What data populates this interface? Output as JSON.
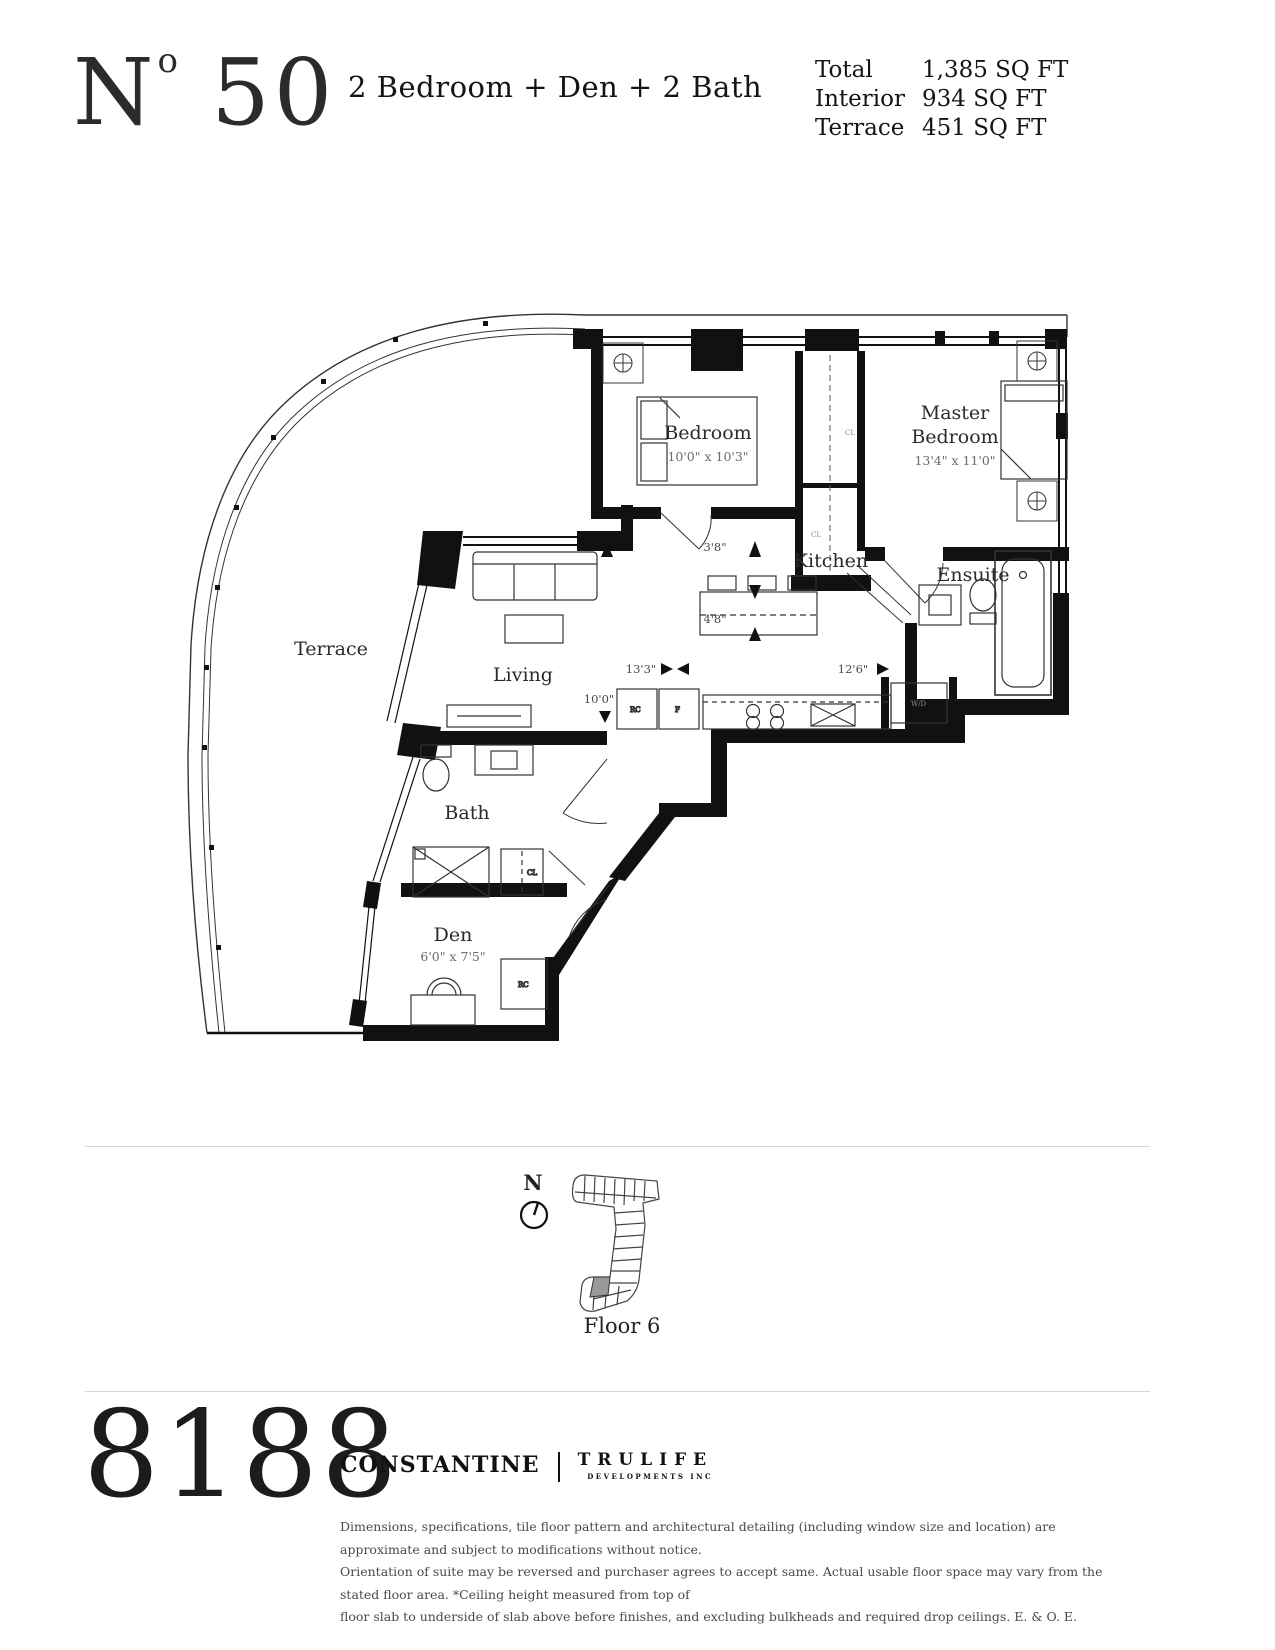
{
  "header": {
    "logo_n": "N",
    "logo_sup": "o",
    "logo_num": " 50",
    "title": "2 Bedroom + Den + 2 Bath",
    "stats": [
      {
        "label": "Total",
        "value": "1,385 SQ FT"
      },
      {
        "label": "Interior",
        "value": "934 SQ FT"
      },
      {
        "label": "Terrace",
        "value": "451 SQ FT"
      }
    ]
  },
  "plan": {
    "rooms": {
      "terrace": {
        "label": "Terrace"
      },
      "living": {
        "label": "Living"
      },
      "kitchen": {
        "label": "Kitchen"
      },
      "bedroom": {
        "label": "Bedroom",
        "dims": "10'0\" x 10'3\""
      },
      "master": {
        "label_line1": "Master",
        "label_line2": "Bedroom",
        "dims": "13'4\" x 11'0\""
      },
      "ensuite": {
        "label": "Ensuite"
      },
      "bath": {
        "label": "Bath"
      },
      "den": {
        "label": "Den",
        "dims": "6'0\" x 7'5\""
      }
    },
    "annotations": {
      "d38": "3'8\"",
      "d48": "4'8\"",
      "d133": "13'3\"",
      "d126": "12'6\"",
      "d100": "10'0\""
    },
    "tiny": {
      "wd": "W/D",
      "cl": "CL",
      "rc": "RC",
      "f": "F"
    }
  },
  "locator": {
    "north_label": "N",
    "floor_label": "Floor 6"
  },
  "footer": {
    "logo": "8188",
    "brand1": "CONSTANTINE",
    "brand2": "TRULIFE",
    "brand2_sub": "DEVELOPMENTS INC",
    "disclaimer_lines": [
      "Dimensions, specifications, tile floor pattern and architectural detailing (including window size and location) are approximate and subject to modifications without notice.",
      "Orientation of suite may be reversed and purchaser agrees to accept same. Actual usable floor space may vary from the stated floor area. *Ceiling height measured from top of",
      "floor slab to underside of slab above before finishes, and excluding bulkheads and required drop ceilings. E. & O. E."
    ]
  },
  "colors": {
    "ink": "#111111",
    "divider": "#d8d8d8",
    "highlight_unit": "#9a9a9a"
  }
}
